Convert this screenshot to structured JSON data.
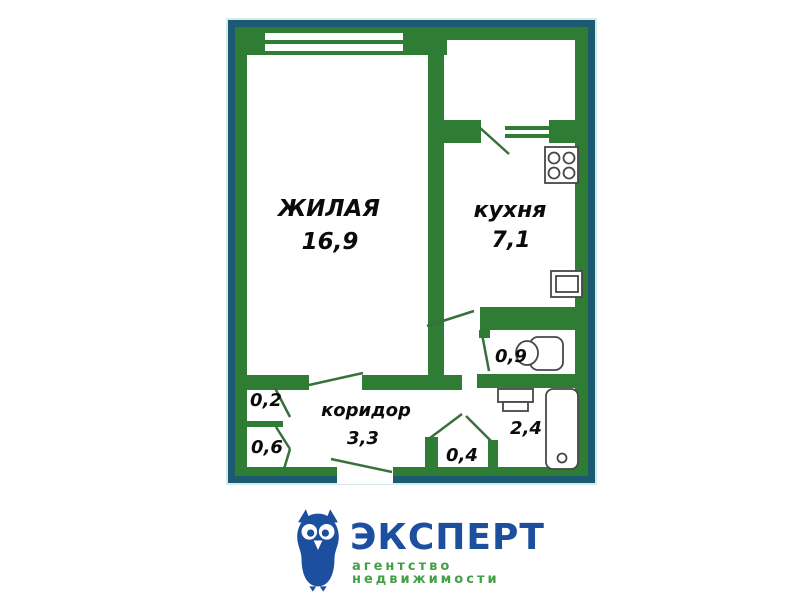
{
  "plan": {
    "living": {
      "name": "ЖИЛАЯ",
      "area": "16,9"
    },
    "kitchen": {
      "name": "кухня",
      "area": "7,1"
    },
    "corridor": {
      "name": "коридор",
      "area": "3,3"
    },
    "wc": {
      "area": "0,9"
    },
    "bathroom": {
      "area": "2,4"
    },
    "closet_upper": {
      "area": "0,2"
    },
    "closet_lower": {
      "area": "0,6"
    },
    "vestibule": {
      "area": "0,4"
    }
  },
  "logo": {
    "brand": "ЭКСПЕРТ",
    "tagline": "агентство недвижимости"
  },
  "colors": {
    "wall_green": "#2f7d35",
    "frame_teal": "#1b5a70",
    "logo_blue": "#1c4f9e",
    "logo_green": "#43a047",
    "label_black": "#0b0b0b"
  }
}
